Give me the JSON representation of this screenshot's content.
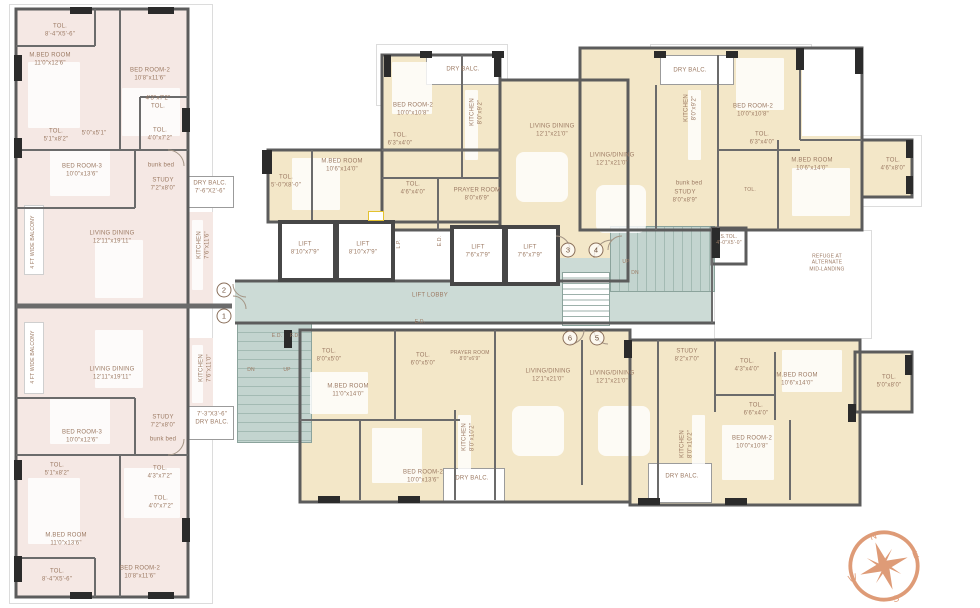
{
  "colors": {
    "wing_pink": "#f5e8e4",
    "wing_cream": "#f3e7c8",
    "core_teal": "#ccdbd6",
    "wall": "#5c5c5c",
    "label_text": "#9c7a63",
    "compass_orange": "#de9b77"
  },
  "compass": {
    "n": "N",
    "e": "E",
    "s": "S",
    "w": "W"
  },
  "unit_markers": [
    {
      "n": "1",
      "x": 224,
      "y": 316
    },
    {
      "n": "2",
      "x": 224,
      "y": 290
    },
    {
      "n": "3",
      "x": 568,
      "y": 250
    },
    {
      "n": "4",
      "x": 596,
      "y": 250
    },
    {
      "n": "5",
      "x": 597,
      "y": 338
    },
    {
      "n": "6",
      "x": 570,
      "y": 338
    }
  ],
  "labels": [
    {
      "name": "room-toilet",
      "lines": [
        "TOL.",
        "8'-4\"X5'-6\""
      ],
      "x": 60,
      "y": 31
    },
    {
      "name": "room-master-bedroom",
      "lines": [
        "M.BED ROOM",
        "11'0\"x12'6\""
      ],
      "x": 50,
      "y": 60
    },
    {
      "name": "room-bedroom-2",
      "lines": [
        "BED ROOM-2",
        "10'8\"x11'6\""
      ],
      "x": 150,
      "y": 75
    },
    {
      "name": "room-toilet",
      "lines": [
        "4'3\"x7'2\"",
        "TOL."
      ],
      "x": 158,
      "y": 103
    },
    {
      "name": "room-toilet",
      "lines": [
        "TOL.",
        "4'0\"x7'2\""
      ],
      "x": 160,
      "y": 135
    },
    {
      "name": "room-toilet",
      "lines": [
        "TOL.",
        "5'1\"x8'2\""
      ],
      "x": 56,
      "y": 136
    },
    {
      "name": "passage-dim",
      "lines": [
        "5'0\"x5'1\""
      ],
      "x": 94,
      "y": 134
    },
    {
      "name": "room-bedroom-3",
      "lines": [
        "BED ROOM-3",
        "10'0\"x13'6\""
      ],
      "x": 82,
      "y": 171
    },
    {
      "name": "furniture-bunk-bed",
      "lines": [
        "bunk bed"
      ],
      "x": 161,
      "y": 166
    },
    {
      "name": "room-study",
      "lines": [
        "STUDY",
        "7'2\"x8'0\""
      ],
      "x": 163,
      "y": 185
    },
    {
      "name": "room-dry-balcony",
      "lines": [
        "DRY BALC.",
        "7'-6\"X2'-6\""
      ],
      "x": 210,
      "y": 188
    },
    {
      "name": "room-living-dining",
      "lines": [
        "LIVING DINING",
        "12'11\"x19'11\""
      ],
      "x": 112,
      "y": 238
    },
    {
      "name": "room-kitchen",
      "lines": [
        "KITCHEN",
        "7'6\"x11'6\""
      ],
      "x": 204,
      "y": 245,
      "v": true
    },
    {
      "name": "balcony-note",
      "lines": [
        "4 FT WIDE BALCONY"
      ],
      "x": 33,
      "y": 242,
      "v": true,
      "s": 5
    },
    {
      "name": "balcony-note",
      "lines": [
        "4 FT WIDE BALCONY"
      ],
      "x": 33,
      "y": 357,
      "v": true,
      "s": 5
    },
    {
      "name": "room-living-dining",
      "lines": [
        "LIVING DINING",
        "12'11\"x19'11\""
      ],
      "x": 112,
      "y": 374
    },
    {
      "name": "room-kitchen",
      "lines": [
        "KITCHEN",
        "7'6\"x11'0\""
      ],
      "x": 206,
      "y": 368,
      "v": true
    },
    {
      "name": "room-dry-balcony",
      "lines": [
        "7'-3\"X3'-6\"",
        "DRY BALC."
      ],
      "x": 212,
      "y": 419
    },
    {
      "name": "room-study",
      "lines": [
        "STUDY",
        "7'2\"x8'0\""
      ],
      "x": 163,
      "y": 422
    },
    {
      "name": "furniture-bunk-bed",
      "lines": [
        "bunk bed"
      ],
      "x": 163,
      "y": 440
    },
    {
      "name": "room-bedroom-3",
      "lines": [
        "BED ROOM-3",
        "10'0\"x12'6\""
      ],
      "x": 82,
      "y": 437
    },
    {
      "name": "room-toilet",
      "lines": [
        "TOL.",
        "5'1\"x8'2\""
      ],
      "x": 57,
      "y": 470
    },
    {
      "name": "room-toilet",
      "lines": [
        "TOL.",
        "4'3\"x7'2\""
      ],
      "x": 160,
      "y": 473
    },
    {
      "name": "room-toilet",
      "lines": [
        "TOL.",
        "4'0\"x7'2\""
      ],
      "x": 161,
      "y": 503
    },
    {
      "name": "room-master-bedroom",
      "lines": [
        "M.BED ROOM",
        "11'0\"x13'6\""
      ],
      "x": 66,
      "y": 540
    },
    {
      "name": "room-toilet",
      "lines": [
        "TOL.",
        "8'-4\"X5'-6\""
      ],
      "x": 57,
      "y": 576
    },
    {
      "name": "room-bedroom-2",
      "lines": [
        "BED ROOM-2",
        "10'8\"x11'6\""
      ],
      "x": 140,
      "y": 573
    },
    {
      "name": "room-dry-balcony",
      "lines": [
        "DRY BALC."
      ],
      "x": 463,
      "y": 70
    },
    {
      "name": "room-bedroom-2",
      "lines": [
        "BED ROOM-2",
        "10'0\"x10'8\""
      ],
      "x": 413,
      "y": 110
    },
    {
      "name": "room-kitchen",
      "lines": [
        "KITCHEN",
        "8'0\"x9'2\""
      ],
      "x": 477,
      "y": 112,
      "v": true
    },
    {
      "name": "room-toilet",
      "lines": [
        "TOL.",
        "6'3\"x4'0\""
      ],
      "x": 400,
      "y": 140
    },
    {
      "name": "room-living-dining",
      "lines": [
        "LIVING DINING",
        "12'1\"x21'0\""
      ],
      "x": 552,
      "y": 131
    },
    {
      "name": "room-toilet",
      "lines": [
        "TOL.",
        "4'6\"x4'0\""
      ],
      "x": 413,
      "y": 189
    },
    {
      "name": "room-prayer",
      "lines": [
        "PRAYER ROOM",
        "8'0\"x6'9\""
      ],
      "x": 477,
      "y": 195
    },
    {
      "name": "room-master-bedroom",
      "lines": [
        "M.BED ROOM",
        "10'6\"x14'0\""
      ],
      "x": 342,
      "y": 166
    },
    {
      "name": "room-toilet",
      "lines": [
        "TOL.",
        "5'-0\"X8'-0\""
      ],
      "x": 286,
      "y": 182
    },
    {
      "name": "room-lift",
      "lines": [
        "LIFT",
        "8'10\"x7'9\""
      ],
      "x": 305,
      "y": 249
    },
    {
      "name": "room-lift",
      "lines": [
        "LIFT",
        "8'10\"x7'9\""
      ],
      "x": 363,
      "y": 249
    },
    {
      "name": "room-lift",
      "lines": [
        "LIFT",
        "7'6\"x7'9\""
      ],
      "x": 478,
      "y": 252
    },
    {
      "name": "room-lift",
      "lines": [
        "LIFT",
        "7'6\"x7'9\""
      ],
      "x": 530,
      "y": 252
    },
    {
      "name": "lift-lobby",
      "lines": [
        "LIFT LOBBY"
      ],
      "x": 430,
      "y": 296
    },
    {
      "name": "duct-lp",
      "lines": [
        "L.P."
      ],
      "x": 399,
      "y": 244,
      "v": true,
      "s": 5
    },
    {
      "name": "duct-ed",
      "lines": [
        "E.D."
      ],
      "x": 440,
      "y": 241,
      "v": true,
      "s": 5
    },
    {
      "name": "stair-up",
      "lines": [
        "UP"
      ],
      "x": 626,
      "y": 262,
      "s": 5
    },
    {
      "name": "stair-dn",
      "lines": [
        "DN"
      ],
      "x": 635,
      "y": 273,
      "s": 5
    },
    {
      "name": "room-servant-toilet",
      "lines": [
        "S.TOL.",
        "4'-0\"X5'-0\""
      ],
      "x": 729,
      "y": 240,
      "s": 5
    },
    {
      "name": "refuge-note",
      "lines": [
        "REFUGE AT",
        "ALTERNATE",
        "MID-LANDING"
      ],
      "x": 827,
      "y": 263,
      "s": 5
    },
    {
      "name": "room-dry-balcony",
      "lines": [
        "DRY BALC."
      ],
      "x": 690,
      "y": 71
    },
    {
      "name": "room-kitchen",
      "lines": [
        "KITCHEN",
        "8'0\"x9'2\""
      ],
      "x": 691,
      "y": 108,
      "v": true
    },
    {
      "name": "room-bedroom-2",
      "lines": [
        "BED ROOM-2",
        "10'0\"x10'8\""
      ],
      "x": 753,
      "y": 111
    },
    {
      "name": "room-toilet",
      "lines": [
        "TOL.",
        "6'3\"x4'0\""
      ],
      "x": 762,
      "y": 139
    },
    {
      "name": "room-living-dining",
      "lines": [
        "LIVING/DINING",
        "12'1\"x21'0\""
      ],
      "x": 612,
      "y": 160
    },
    {
      "name": "furniture-bunk-bed",
      "lines": [
        "bunk bed"
      ],
      "x": 689,
      "y": 184
    },
    {
      "name": "room-study",
      "lines": [
        "STUDY",
        "8'0\"x8'9\""
      ],
      "x": 685,
      "y": 197
    },
    {
      "name": "room-master-bedroom",
      "lines": [
        "M.BED ROOM",
        "10'6\"x14'0\""
      ],
      "x": 812,
      "y": 165
    },
    {
      "name": "room-toilet",
      "lines": [
        "TOL."
      ],
      "x": 750,
      "y": 190,
      "s": 5
    },
    {
      "name": "room-toilet",
      "lines": [
        "TOL.",
        "4'6\"x8'0\""
      ],
      "x": 893,
      "y": 165
    },
    {
      "name": "duct-ed",
      "lines": [
        "E.D."
      ],
      "x": 420,
      "y": 322,
      "s": 5
    },
    {
      "name": "duct-ed",
      "lines": [
        "E.D."
      ],
      "x": 277,
      "y": 336,
      "s": 5
    },
    {
      "name": "duct-fd",
      "lines": [
        "F.D."
      ],
      "x": 295,
      "y": 336,
      "s": 5
    },
    {
      "name": "stair-dn",
      "lines": [
        "DN"
      ],
      "x": 251,
      "y": 370,
      "s": 5
    },
    {
      "name": "stair-up",
      "lines": [
        "UP"
      ],
      "x": 287,
      "y": 370,
      "s": 5
    },
    {
      "name": "room-toilet",
      "lines": [
        "TOL.",
        "8'0\"x5'0\""
      ],
      "x": 329,
      "y": 356
    },
    {
      "name": "room-toilet",
      "lines": [
        "TOL.",
        "6'0\"x5'0\""
      ],
      "x": 423,
      "y": 360
    },
    {
      "name": "room-prayer",
      "lines": [
        "PRAYER ROOM",
        "8'0\"x6'9\""
      ],
      "x": 470,
      "y": 356,
      "s": 5
    },
    {
      "name": "room-master-bedroom",
      "lines": [
        "M.BED ROOM",
        "11'0\"x14'0\""
      ],
      "x": 348,
      "y": 391
    },
    {
      "name": "room-living-dining",
      "lines": [
        "LIVING/DINING",
        "12'1\"x21'0\""
      ],
      "x": 548,
      "y": 376
    },
    {
      "name": "room-living-dining",
      "lines": [
        "LIVING/DINING",
        "12'1\"x21'0\""
      ],
      "x": 612,
      "y": 378
    },
    {
      "name": "room-study",
      "lines": [
        "STUDY",
        "8'2\"x7'0\""
      ],
      "x": 687,
      "y": 356
    },
    {
      "name": "room-bedroom-2",
      "lines": [
        "BED ROOM-2",
        "10'0\"x13'6\""
      ],
      "x": 423,
      "y": 477
    },
    {
      "name": "room-kitchen",
      "lines": [
        "KITCHEN",
        "8'0\"x10'2\""
      ],
      "x": 469,
      "y": 437,
      "v": true
    },
    {
      "name": "room-dry-balcony",
      "lines": [
        "DRY BALC."
      ],
      "x": 472,
      "y": 479
    },
    {
      "name": "room-toilet",
      "lines": [
        "TOL.",
        "4'3\"x4'0\""
      ],
      "x": 747,
      "y": 366
    },
    {
      "name": "room-master-bedroom",
      "lines": [
        "M.BED ROOM",
        "10'6\"x14'0\""
      ],
      "x": 797,
      "y": 380
    },
    {
      "name": "room-toilet",
      "lines": [
        "TOL.",
        "5'0\"x8'0\""
      ],
      "x": 889,
      "y": 382
    },
    {
      "name": "room-toilet",
      "lines": [
        "TOL.",
        "6'6\"x4'0\""
      ],
      "x": 756,
      "y": 410
    },
    {
      "name": "room-bedroom-2",
      "lines": [
        "BED ROOM-2",
        "10'0\"x10'8\""
      ],
      "x": 752,
      "y": 443
    },
    {
      "name": "room-kitchen",
      "lines": [
        "KITCHEN",
        "8'0\"x10'2\""
      ],
      "x": 687,
      "y": 444,
      "v": true
    },
    {
      "name": "room-dry-balcony",
      "lines": [
        "DRY BALC."
      ],
      "x": 682,
      "y": 477
    }
  ]
}
